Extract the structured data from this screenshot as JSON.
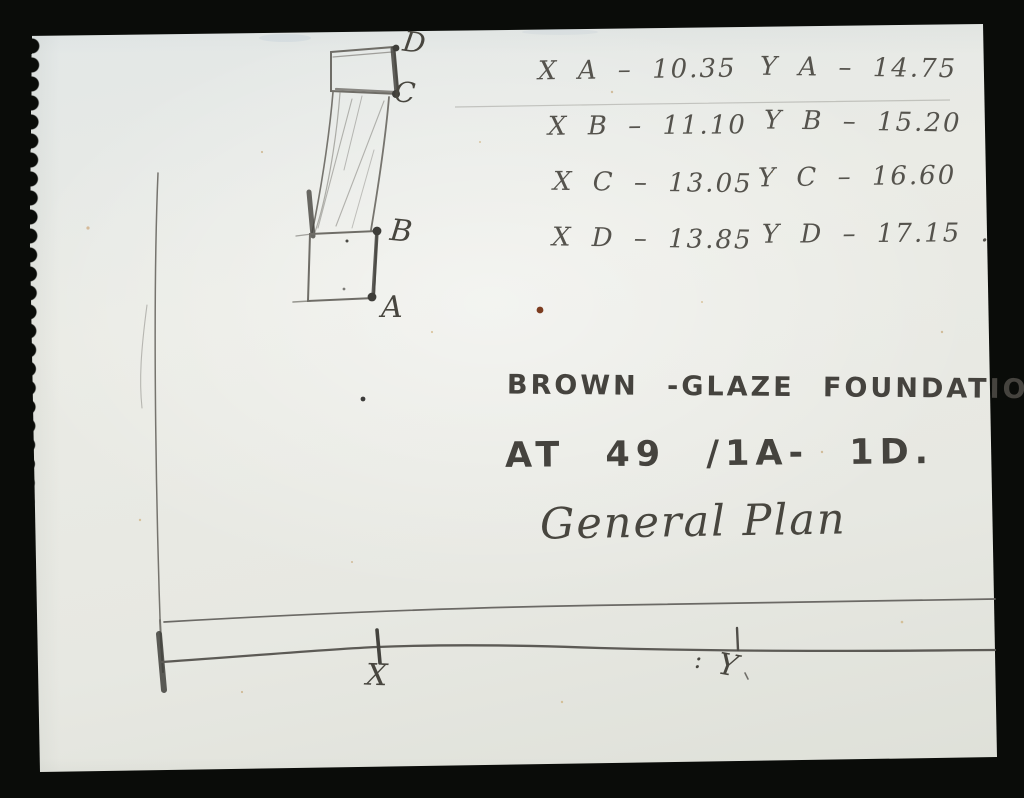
{
  "palette": {
    "background": "#0a0c09",
    "paper": "#e7e9e3",
    "pencil_light": "#6b6965",
    "pencil_dark": "#403f3b",
    "rust_speck": "#7c3c20"
  },
  "measurements": {
    "rows": [
      {
        "left": "X A – 10.35",
        "right": "Y A – 14.75"
      },
      {
        "left": "X B – 11.10",
        "right": "Y B – 15.20"
      },
      {
        "left": "X C – 13.05",
        "right": "Y C – 16.60"
      },
      {
        "left": "X D – 13.85",
        "right": "Y D – 17.15 ."
      }
    ]
  },
  "caption": {
    "line1": "BROWN -GLAZE FOUNDATIONS",
    "line2": "AT 49 /1A- 1D.",
    "line3": "General Plan"
  },
  "sketch_labels": {
    "d": "D",
    "c": "C",
    "b": "B",
    "a": "A",
    "x_axis": "X",
    "y_colon": ":",
    "y_axis": "Y"
  }
}
